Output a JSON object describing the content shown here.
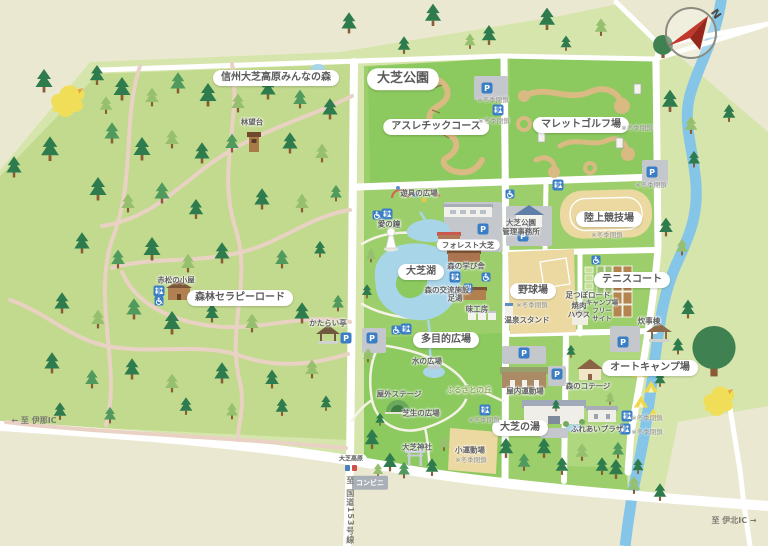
{
  "compass": {
    "north": "N"
  },
  "icons": {
    "parking": "P"
  },
  "colors": {
    "beige": "#ebe8d1",
    "pale_green": "#d6e5ac",
    "forest_green": "#c2da8e",
    "park_green": "#9ccf6b",
    "bright_green": "#8cc95f",
    "camp_green": "#aed77e",
    "water": "#a9d5e9",
    "river": "#85c6e8",
    "field_tan": "#ecd9a2",
    "course_tan": "#d8ba82",
    "trail_pink": "#e9d2c4",
    "road_white": "#ffffff",
    "icon_blue": "#3a7ec6",
    "pill_text": "#5a5a5a"
  },
  "labels": {
    "winter_note": "※冬季閉鎖",
    "pills": [
      "信州大芝高原みんなの森",
      "大芝公園",
      "アスレチックコース",
      "マレットゴルフ場",
      "森林セラピーロード",
      "大芝湖",
      "陸上競技場",
      "テニスコート",
      "野球場",
      "多目的広場",
      "大芝の湯",
      "オートキャンプ場",
      "フォレスト大芝",
      "大芝高原"
    ],
    "places": [
      "林望台",
      "遊具の広場",
      "愛の鐘",
      "森の学び舎",
      "森の交流施設",
      "足湯",
      "味工房",
      "大芝公園\n管理事務所",
      "温泉スタンド",
      "足つぼロード",
      "焼肉\nハウス",
      "キャンプ場\nフリー\nサイト",
      "炊事棟",
      "水の広場",
      "ふるさとの丘",
      "屋外ステージ",
      "芝生の広場",
      "大芝神社",
      "小運動場",
      "屋内運動場",
      "森のコテージ",
      "ふれあいプラザ",
      "かたらい亭",
      "赤松の小屋",
      "コンビニ"
    ],
    "roads": [
      "← 至 伊那IC",
      "至 国道153号線 ↓",
      "至 伊北IC →"
    ]
  }
}
